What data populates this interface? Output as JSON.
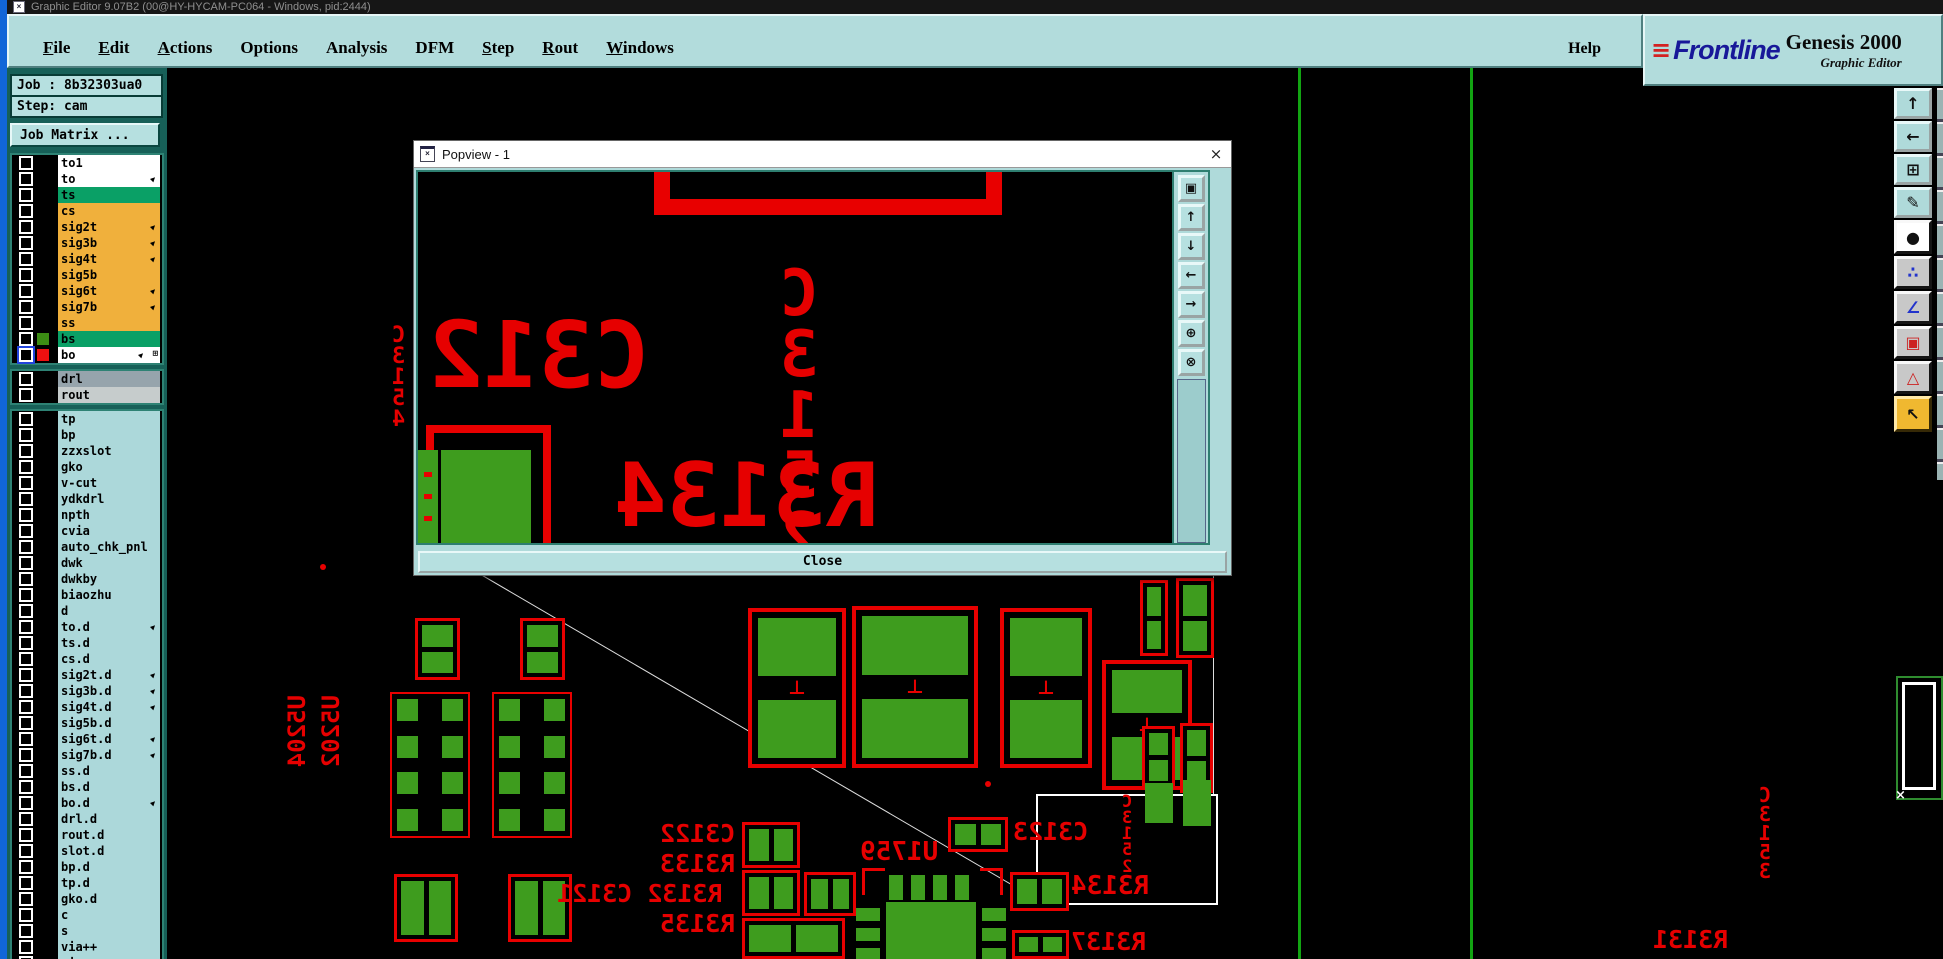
{
  "window": {
    "title": "Graphic Editor 9.07B2 (00@HY-HYCAM-PC064 - Windows, pid:2444)",
    "icon_glyph": "×"
  },
  "menu": {
    "items": [
      {
        "label": "File",
        "underline": true
      },
      {
        "label": "Edit",
        "underline": true
      },
      {
        "label": "Actions",
        "underline": true
      },
      {
        "label": "Options",
        "underline": false
      },
      {
        "label": "Analysis",
        "underline": false
      },
      {
        "label": "DFM",
        "underline": false
      },
      {
        "label": "Step",
        "underline": true
      },
      {
        "label": "Rout",
        "underline": true
      },
      {
        "label": "Windows",
        "underline": true
      }
    ],
    "help": "Help"
  },
  "brand": {
    "speed_lines": "≡",
    "name": "Frontline",
    "product": "Genesis 2000",
    "subtitle": "Graphic Editor"
  },
  "job": {
    "job": "Job : 8b32303ua0",
    "step": "Step: cam",
    "matrix": "Job Matrix ..."
  },
  "colors": {
    "ui_teal": "#B2DCDC",
    "sidebar_bg": "#176058",
    "layer_white": "#FFFFFF",
    "layer_green": "#0AA066",
    "layer_orange": "#F0B03C",
    "layer_drl": "#96A4AC",
    "layer_rout": "#C6CCCC",
    "layer_cyan": "#ACD8DA",
    "swatch_green": "#3C8C14",
    "swatch_red": "#EE1010",
    "pcb_green": "#3E9C1E",
    "pcb_red": "#E80000"
  },
  "layers": {
    "icons": {
      "arrow": "▶",
      "extra": "⊞"
    },
    "sections": [
      {
        "rows": [
          {
            "name": "to1",
            "bg": "#FFFFFF"
          },
          {
            "name": "to",
            "bg": "#FFFFFF",
            "arrow": true
          },
          {
            "name": "ts",
            "bg": "#0AA066"
          },
          {
            "name": "cs",
            "bg": "#F0B03C"
          },
          {
            "name": "sig2t",
            "bg": "#F0B03C",
            "arrow": true
          },
          {
            "name": "sig3b",
            "bg": "#F0B03C",
            "arrow": true
          },
          {
            "name": "sig4t",
            "bg": "#F0B03C",
            "arrow": true
          },
          {
            "name": "sig5b",
            "bg": "#F0B03C"
          },
          {
            "name": "sig6t",
            "bg": "#F0B03C",
            "arrow": true
          },
          {
            "name": "sig7b",
            "bg": "#F0B03C",
            "arrow": true
          },
          {
            "name": "ss",
            "bg": "#F0B03C"
          },
          {
            "name": "bs",
            "bg": "#0AA066",
            "swatch": "#3C8C14"
          },
          {
            "name": "bo",
            "bg": "#FFFFFF",
            "swatch": "#EE1010",
            "selected": true,
            "arrow": true,
            "extra": true
          }
        ]
      },
      {
        "rows": [
          {
            "name": "drl",
            "bg": "#96A4AC"
          },
          {
            "name": "rout",
            "bg": "#C6CCCC"
          }
        ]
      },
      {
        "rows": [
          {
            "name": "tp",
            "bg": "#ACD8DA"
          },
          {
            "name": "bp",
            "bg": "#ACD8DA"
          },
          {
            "name": "zzxslot",
            "bg": "#ACD8DA"
          },
          {
            "name": "gko",
            "bg": "#ACD8DA"
          },
          {
            "name": "v-cut",
            "bg": "#ACD8DA"
          },
          {
            "name": "ydkdrl",
            "bg": "#ACD8DA"
          },
          {
            "name": "npth",
            "bg": "#ACD8DA"
          },
          {
            "name": "cvia",
            "bg": "#ACD8DA"
          },
          {
            "name": "auto_chk_pnl",
            "bg": "#ACD8DA"
          },
          {
            "name": "dwk",
            "bg": "#ACD8DA"
          },
          {
            "name": "dwkby",
            "bg": "#ACD8DA"
          },
          {
            "name": "biaozhu",
            "bg": "#ACD8DA"
          },
          {
            "name": "d",
            "bg": "#ACD8DA"
          },
          {
            "name": "to.d",
            "bg": "#ACD8DA",
            "arrow": true
          },
          {
            "name": "ts.d",
            "bg": "#ACD8DA"
          },
          {
            "name": "cs.d",
            "bg": "#ACD8DA"
          },
          {
            "name": "sig2t.d",
            "bg": "#ACD8DA",
            "arrow": true
          },
          {
            "name": "sig3b.d",
            "bg": "#ACD8DA",
            "arrow": true
          },
          {
            "name": "sig4t.d",
            "bg": "#ACD8DA",
            "arrow": true
          },
          {
            "name": "sig5b.d",
            "bg": "#ACD8DA"
          },
          {
            "name": "sig6t.d",
            "bg": "#ACD8DA",
            "arrow": true
          },
          {
            "name": "sig7b.d",
            "bg": "#ACD8DA",
            "arrow": true
          },
          {
            "name": "ss.d",
            "bg": "#ACD8DA"
          },
          {
            "name": "bs.d",
            "bg": "#ACD8DA"
          },
          {
            "name": "bo.d",
            "bg": "#ACD8DA",
            "arrow": true
          },
          {
            "name": "drl.d",
            "bg": "#ACD8DA"
          },
          {
            "name": "rout.d",
            "bg": "#ACD8DA"
          },
          {
            "name": "slot.d",
            "bg": "#ACD8DA"
          },
          {
            "name": "bp.d",
            "bg": "#ACD8DA"
          },
          {
            "name": "tp.d",
            "bg": "#ACD8DA"
          },
          {
            "name": "gko.d",
            "bg": "#ACD8DA"
          },
          {
            "name": "c",
            "bg": "#ACD8DA"
          },
          {
            "name": "s",
            "bg": "#ACD8DA"
          },
          {
            "name": "via++",
            "bg": "#ACD8DA"
          },
          {
            "name": "via+++",
            "bg": "#ACD8DA"
          }
        ]
      }
    ]
  },
  "popview": {
    "title": "Popview - 1",
    "icon_glyph": "×",
    "close_glyph": "×",
    "close_label": "Close",
    "texts": {
      "c312": "C312",
      "c3152": "C\n3\n1\n5\n2",
      "r3134": "R3134"
    },
    "nav_icons": [
      {
        "name": "detach-view-icon",
        "glyph": "▣"
      },
      {
        "name": "pan-up-icon",
        "glyph": "↑"
      },
      {
        "name": "pan-down-icon",
        "glyph": "↓"
      },
      {
        "name": "pan-left-icon",
        "glyph": "←"
      },
      {
        "name": "pan-right-icon",
        "glyph": "→"
      },
      {
        "name": "zoom-in-icon",
        "glyph": "⊕"
      },
      {
        "name": "zoom-out-icon",
        "glyph": "⊗"
      }
    ]
  },
  "toolbar": {
    "buttons": [
      {
        "name": "pan-up-button",
        "glyph": "↑",
        "bg": "teal",
        "fg": "#111"
      },
      {
        "name": "pan-left-button",
        "glyph": "←",
        "bg": "teal",
        "fg": "#111"
      },
      {
        "name": "zoom-fit-button",
        "glyph": "⊞",
        "bg": "teal",
        "fg": "#111"
      },
      {
        "name": "setup-button",
        "glyph": "✎",
        "bg": "teal",
        "fg": "#111"
      },
      {
        "name": "select-feature-button",
        "glyph": "●",
        "bg": "white",
        "fg": "#111"
      },
      {
        "name": "netlist-button",
        "glyph": "∴",
        "bg": "gray",
        "fg": "#2233CC"
      },
      {
        "name": "measure-angle-button",
        "glyph": "∠",
        "bg": "gray",
        "fg": "#2233CC"
      },
      {
        "name": "copy-feature-button",
        "glyph": "▣",
        "bg": "gray",
        "fg": "#CC2222"
      },
      {
        "name": "drc-button",
        "glyph": "△",
        "bg": "gray",
        "fg": "#CC2222"
      },
      {
        "name": "pointer-button",
        "glyph": "↖",
        "bg": "yellow",
        "fg": "#111"
      }
    ]
  },
  "canvas": {
    "glyphs": {
      "polarity": "⊥",
      "cross": "×"
    },
    "green_lines": [
      {
        "x": 1131
      },
      {
        "x": 1303
      }
    ],
    "parts": [
      {
        "t": "soic",
        "x": 223,
        "y": 624,
        "w": 80,
        "h": 146
      },
      {
        "t": "soic",
        "x": 325,
        "y": 624,
        "w": 80,
        "h": 146
      },
      {
        "t": "p2v",
        "x": 248,
        "y": 550,
        "w": 45,
        "h": 62
      },
      {
        "t": "p2v",
        "x": 353,
        "y": 550,
        "w": 45,
        "h": 62
      },
      {
        "t": "dot",
        "x": 153,
        "y": 496
      },
      {
        "t": "dot",
        "x": 246,
        "y": 496
      },
      {
        "t": "dot",
        "x": 818,
        "y": 713
      },
      {
        "t": "p2h",
        "x": 227,
        "y": 806,
        "w": 64,
        "h": 68
      },
      {
        "t": "p2h",
        "x": 341,
        "y": 806,
        "w": 64,
        "h": 68
      },
      {
        "t": "cap",
        "x": 581,
        "y": 540,
        "w": 98,
        "h": 160
      },
      {
        "t": "cap",
        "x": 685,
        "y": 538,
        "w": 126,
        "h": 162
      },
      {
        "t": "cap",
        "x": 833,
        "y": 540,
        "w": 92,
        "h": 160
      },
      {
        "t": "cap",
        "x": 935,
        "y": 592,
        "w": 90,
        "h": 130
      },
      {
        "t": "p2v",
        "x": 973,
        "y": 512,
        "w": 28,
        "h": 76
      },
      {
        "t": "p2v",
        "x": 1009,
        "y": 510,
        "w": 38,
        "h": 80
      },
      {
        "t": "p2v",
        "x": 975,
        "y": 658,
        "w": 33,
        "h": 62
      },
      {
        "t": "p2v",
        "x": 1013,
        "y": 655,
        "w": 33,
        "h": 70
      },
      {
        "t": "pad",
        "x": 978,
        "y": 715,
        "w": 28,
        "h": 40
      },
      {
        "t": "pad",
        "x": 1016,
        "y": 712,
        "w": 28,
        "h": 46
      },
      {
        "t": "p2h",
        "x": 781,
        "y": 749,
        "w": 60,
        "h": 35
      },
      {
        "t": "p2h",
        "x": 843,
        "y": 804,
        "w": 59,
        "h": 39
      },
      {
        "t": "p2h",
        "x": 845,
        "y": 862,
        "w": 57,
        "h": 29
      },
      {
        "t": "p2h",
        "x": 575,
        "y": 754,
        "w": 58,
        "h": 46
      },
      {
        "t": "p2h",
        "x": 575,
        "y": 802,
        "w": 58,
        "h": 46
      },
      {
        "t": "p2h",
        "x": 575,
        "y": 850,
        "w": 103,
        "h": 41
      },
      {
        "t": "p2h",
        "x": 637,
        "y": 804,
        "w": 52,
        "h": 44
      },
      {
        "t": "qfn",
        "x": 689,
        "y": 800,
        "w": 150,
        "h": 91
      }
    ],
    "labels": [
      {
        "text": "C\n3\n1\n5\n4",
        "x": 225,
        "y": 258,
        "fs": 22,
        "m": "v"
      },
      {
        "text": "U5204",
        "x": 119,
        "y": 627,
        "fs": 24,
        "m": "r"
      },
      {
        "text": "U5202",
        "x": 153,
        "y": 627,
        "fs": 24,
        "m": "r"
      },
      {
        "text": "C3122",
        "x": 493,
        "y": 754,
        "fs": 25,
        "m": "h"
      },
      {
        "text": "R3133",
        "x": 493,
        "y": 784,
        "fs": 25,
        "m": "h"
      },
      {
        "text": "R3132 C3121",
        "x": 390,
        "y": 814,
        "fs": 25,
        "m": "h"
      },
      {
        "text": "R3135",
        "x": 493,
        "y": 844,
        "fs": 25,
        "m": "h"
      },
      {
        "text": "U1759",
        "x": 693,
        "y": 772,
        "fs": 26,
        "m": "h"
      },
      {
        "text": "C3123",
        "x": 846,
        "y": 752,
        "fs": 25,
        "m": "h"
      },
      {
        "text": "R3134",
        "x": 904,
        "y": 806,
        "fs": 26,
        "m": "h"
      },
      {
        "text": "C\n3\n1\n5\n2",
        "x": 955,
        "y": 726,
        "fs": 17,
        "m": "v"
      },
      {
        "text": "R3137",
        "x": 904,
        "y": 862,
        "fs": 25,
        "m": "h"
      },
      {
        "text": "R3131",
        "x": 1486,
        "y": 860,
        "fs": 25,
        "m": "h"
      },
      {
        "text": "C\n3\n1\n5\n3",
        "x": 1592,
        "y": 718,
        "fs": 20,
        "m": "v"
      }
    ]
  }
}
